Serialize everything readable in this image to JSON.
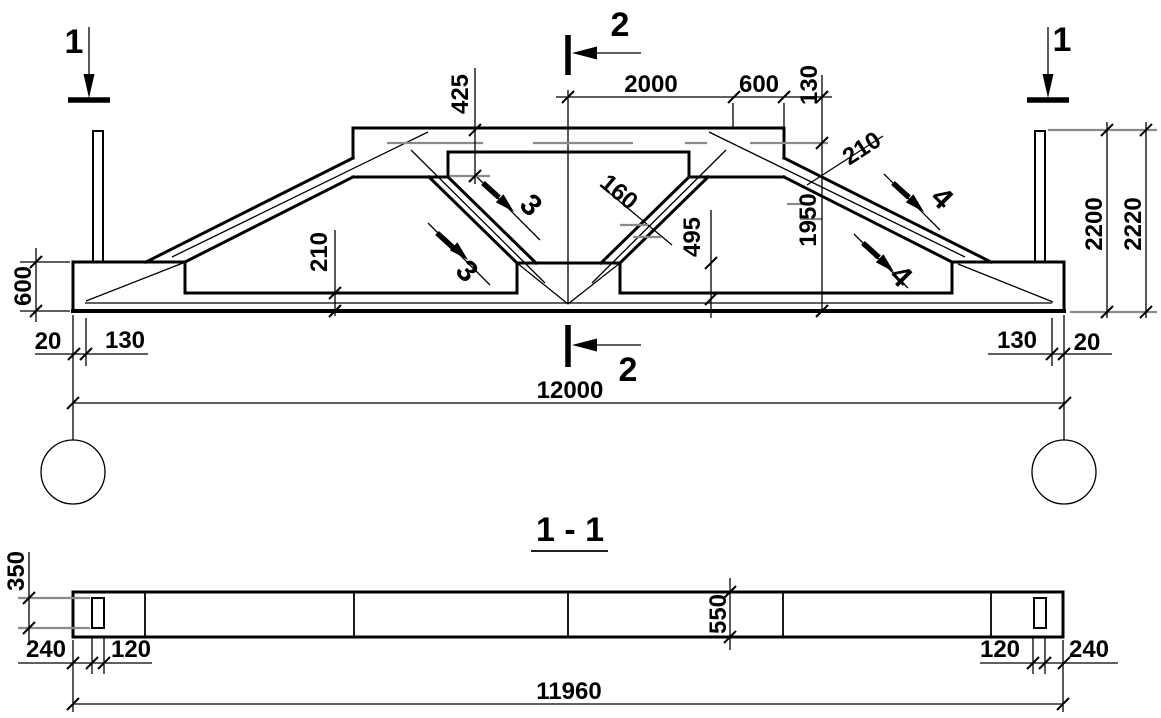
{
  "drawing": {
    "kind": "reinforced-concrete gable lattice girder — elevation and section view"
  },
  "elevation": {
    "marks": {
      "sec1_left": "1",
      "sec1_right": "1",
      "sec2_top": "2",
      "sec2_bottom": "2",
      "cut3_upper": "3",
      "cut3_lower": "3",
      "cut4_upper": "4",
      "cut4_lower": "4"
    },
    "dims": {
      "d2000": "2000",
      "d600_top": "600",
      "d130_top": "130",
      "d425": "425",
      "d210_slope": "210",
      "d1950": "1950",
      "d2200": "2200",
      "d2220": "2220",
      "d160": "160",
      "d495": "495",
      "d210_chord": "210",
      "d600_left": "600",
      "d20_left": "20",
      "d130_left": "130",
      "d130_right": "130",
      "d20_right": "20",
      "d12000": "12000"
    }
  },
  "section": {
    "title": "1 - 1",
    "dims": {
      "d350": "350",
      "d550": "550",
      "d240_left": "240",
      "d120_left": "120",
      "d120_right": "120",
      "d240_right": "240",
      "d11960": "11960"
    }
  },
  "colors": {
    "ink": "#000000",
    "reference_gray": "#8a8a8a",
    "background": "#ffffff"
  }
}
